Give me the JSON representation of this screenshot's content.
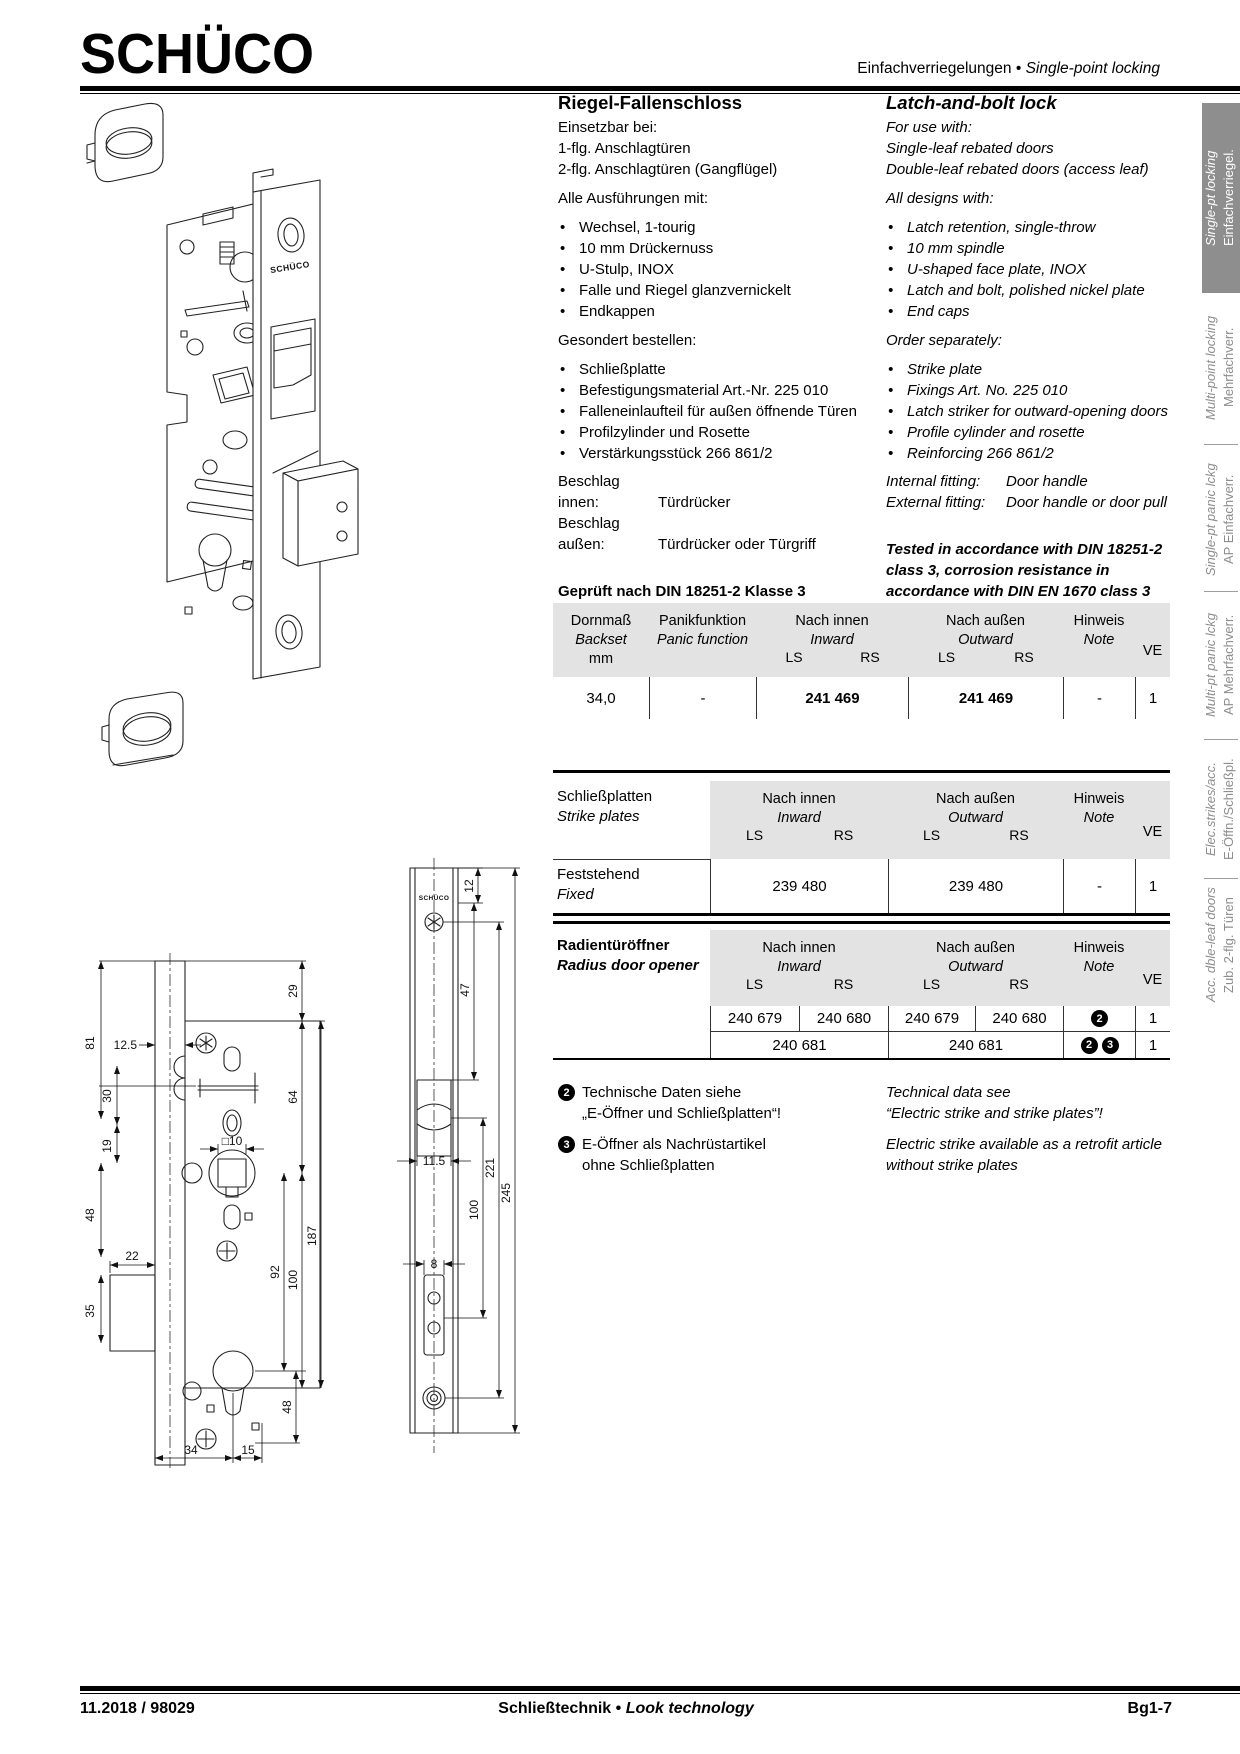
{
  "header": {
    "logo": "SCHÜCO",
    "title_de": "Einfachverriegelungen",
    "sep": "•",
    "title_en": "Single-point locking"
  },
  "sidebar": {
    "tabs": [
      {
        "en": "Single-pt locking",
        "de": "Einfachverriegel."
      },
      {
        "en": "Multi-point locking",
        "de": "Mehrfachverr."
      },
      {
        "en": "Single-pt panic lckg",
        "de": "AP Einfachverr."
      },
      {
        "en": "Multi-pt panic lckg",
        "de": "AP Mehrfachverr."
      },
      {
        "en": "Elec.strikes/acc.",
        "de": "E-Öffn./Schließpl."
      },
      {
        "en": "Acc. dble-leaf doors",
        "de": "Zub. 2-flg. Türen"
      }
    ]
  },
  "product": {
    "de": {
      "title": "Riegel-Fallenschloss",
      "intro": [
        "Einsetzbar bei:",
        "1-flg. Anschlagtüren",
        "2-flg. Anschlagtüren (Gangflügel)"
      ],
      "designs_heading": "Alle Ausführungen mit:",
      "designs": [
        "Wechsel, 1-tourig",
        "10 mm Drückernuss",
        "U-Stulp, INOX",
        "Falle und Riegel glanzvernickelt",
        "Endkappen"
      ],
      "order_heading": "Gesondert bestellen:",
      "order": [
        "Schließplatte",
        "Befestigungsmaterial Art.-Nr. 225 010",
        "Falleneinlaufteil für außen öffnende Türen",
        "Profilzylinder und Rosette",
        "Verstärkungsstück 266 861/2"
      ],
      "fitting1_label": "Beschlag innen:",
      "fitting1_value": "Türdrücker",
      "fitting2_label": "Beschlag außen:",
      "fitting2_value": "Türdrücker oder Türgriff",
      "tested": [
        "Geprüft nach DIN 18251-2 Klasse 3",
        "Korrosionsbeständigkeit nach",
        "DIN EN 1670 Klasse 3"
      ]
    },
    "en": {
      "title": "Latch-and-bolt lock",
      "intro": [
        "For use with:",
        "Single-leaf rebated doors",
        "Double-leaf rebated doors (access leaf)"
      ],
      "designs_heading": "All designs with:",
      "designs": [
        "Latch retention, single-throw",
        "10 mm spindle",
        "U-shaped face plate, INOX",
        "Latch and bolt, polished nickel plate",
        "End caps"
      ],
      "order_heading": "Order separately:",
      "order": [
        "Strike plate",
        "Fixings Art. No. 225 010",
        "Latch striker for outward-opening doors",
        "Profile cylinder and rosette",
        "Reinforcing 266 861/2"
      ],
      "fitting1_label": "Internal fitting:",
      "fitting1_value": "Door handle",
      "fitting2_label": "External fitting:",
      "fitting2_value": "Door handle or door pull",
      "tested": [
        "Tested in accordance with DIN 18251-2",
        "class 3, corrosion resistance in",
        "accordance with DIN EN 1670 class 3"
      ]
    }
  },
  "table_common": {
    "inward_de": "Nach innen",
    "inward_en": "Inward",
    "outward_de": "Nach außen",
    "outward_en": "Outward",
    "ls": "LS",
    "rs": "RS",
    "note_de": "Hinweis",
    "note_en": "Note",
    "ve": "VE"
  },
  "table_backset": {
    "col1": [
      "Dornmaß",
      "Backset",
      "mm"
    ],
    "col2": [
      "Panikfunktion",
      "Panic function"
    ],
    "row": {
      "backset": "34,0",
      "panic": "-",
      "inward": "241 469",
      "outward": "241 469",
      "note": "-",
      "ve": "1"
    }
  },
  "table_strike": {
    "label_de": "Schließplatten",
    "label_en": "Strike plates",
    "row_label_de": "Feststehend",
    "row_label_en": "Fixed",
    "row": {
      "inward": "239 480",
      "outward": "239 480",
      "note": "-",
      "ve": "1"
    }
  },
  "table_radius": {
    "label_de": "Radientüröffner",
    "label_en": "Radius door opener",
    "row1": {
      "in_ls": "240 679",
      "in_rs": "240 680",
      "out_ls": "240 679",
      "out_rs": "240 680",
      "note": "2",
      "ve": "1"
    },
    "row2": {
      "inward": "240 681",
      "outward": "240 681",
      "note_a": "2",
      "note_b": "3",
      "ve": "1"
    }
  },
  "footnotes": [
    {
      "num": "2",
      "de1": "Technische Daten siehe",
      "de2": "„E-Öffner und Schließplatten“!",
      "en1": "Technical data see",
      "en2": "“Electric strike and strike plates”!"
    },
    {
      "num": "3",
      "de1": "E-Öffner als Nachrüstartikel",
      "de2": "ohne Schließplatten",
      "en1": "Electric strike available as a retrofit article",
      "en2": "without strike plates"
    }
  ],
  "drawings": {
    "brand": "SCHÜCO",
    "front_dims": [
      "29",
      "12.5",
      "81",
      "30",
      "19",
      "48",
      "22",
      "35",
      "□10",
      "64",
      "92",
      "100",
      "187",
      "48",
      "34",
      "15"
    ],
    "plate_dims": [
      "12",
      "47",
      "11.5",
      "100",
      "8",
      "221",
      "245"
    ]
  },
  "footer": {
    "left": "11.2018 / 98029",
    "center_de": "Schließtechnik",
    "sep": "•",
    "center_en": "Look technology",
    "right": "Bg1-7"
  }
}
